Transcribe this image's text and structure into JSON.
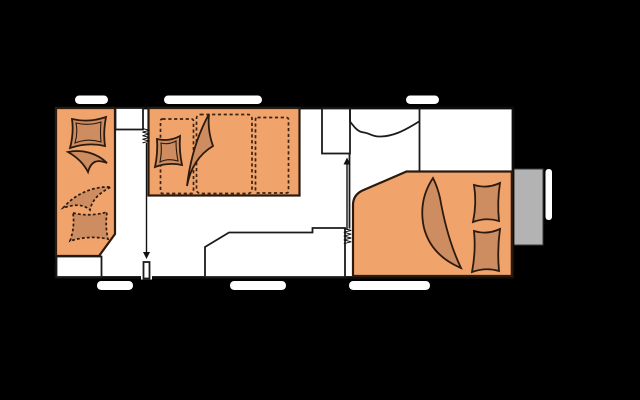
{
  "drawing": {
    "kind": "caravan-floor-plan",
    "elements": [
      "caravan-body-outline",
      "rear-lounge-seat",
      "lounge-cushion",
      "lounge-blanket",
      "lounge-cushion-dashed",
      "lounge-blanket-dashed",
      "rear-bench",
      "side-cabinet",
      "bunk-bed",
      "bunk-upper-dashed-outlines",
      "bunk-cushion",
      "bunk-blanket",
      "kitchen-counter",
      "washroom-cabinet",
      "washbasin-curve",
      "front-french-bed",
      "bed-cushion-1",
      "bed-cushion-2",
      "bed-blanket",
      "entry-door-rear",
      "entry-door-front",
      "door-swing-arrows",
      "concertina-door-symbols",
      "windows-top-x3",
      "windows-bottom-x3",
      "gas-locker-box",
      "drawbar-handle"
    ]
  },
  "colors": {
    "background": "#000000",
    "floor": "#ffffff",
    "furniture": "#f1a36c",
    "cushion": "#ce8d60",
    "locker": "#b3b3b3"
  }
}
